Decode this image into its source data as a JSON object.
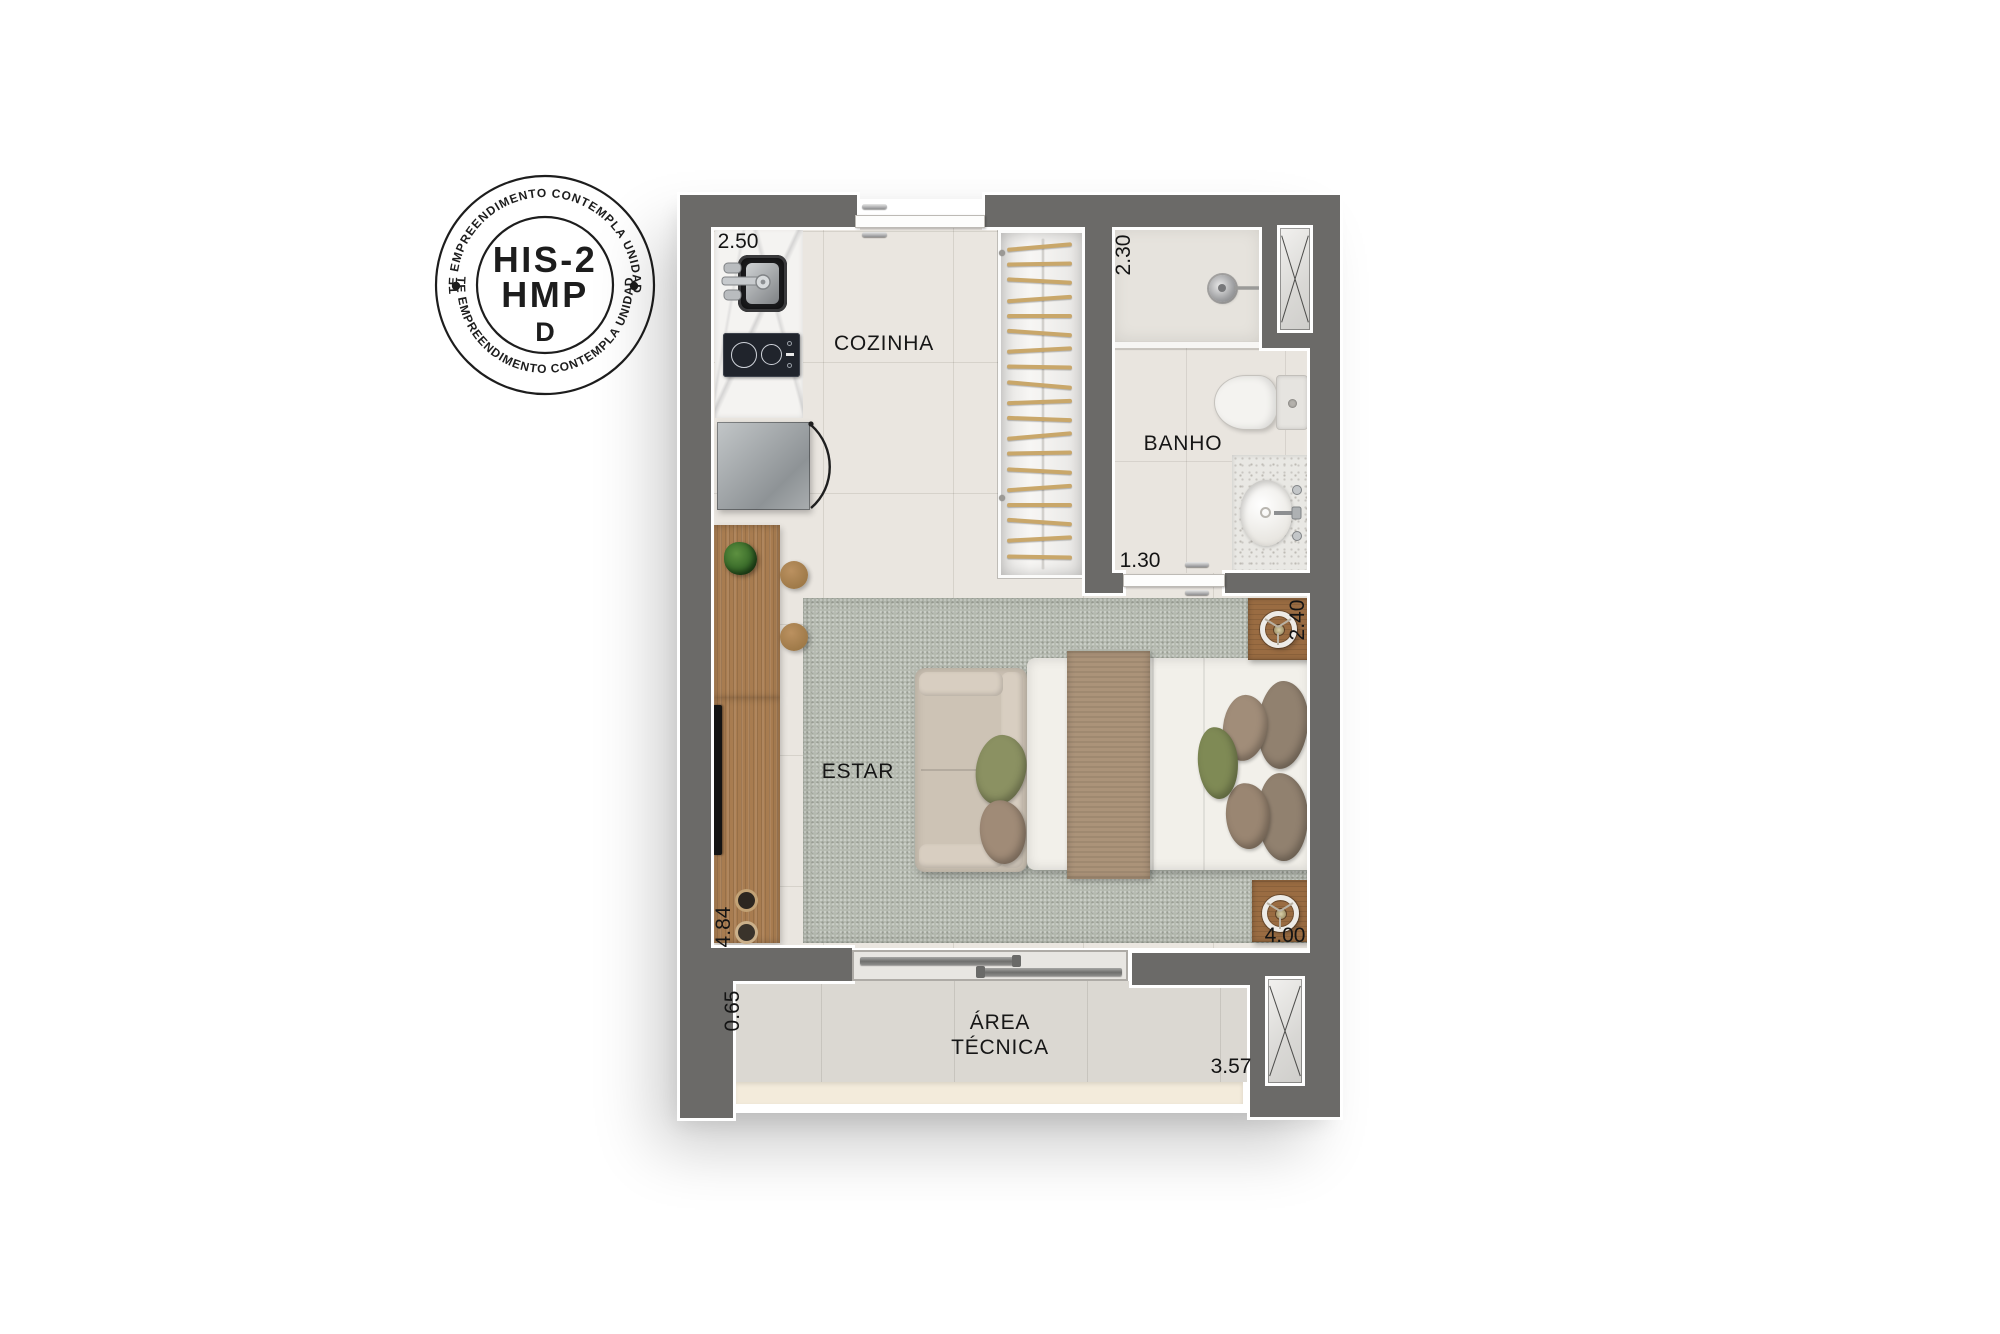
{
  "stamp": {
    "arc_text_top": "ESTE EMPREENDIMENTO CONTEMPLA UNIDADES",
    "arc_text_bottom": "ESTE EMPREENDIMENTO CONTEMPLA UNIDADES",
    "code_line1": "HIS-2",
    "code_line2": "HMP",
    "logo_letter": "D"
  },
  "rooms": {
    "kitchen": "COZINHA",
    "bathroom": "BANHO",
    "living": "ESTAR",
    "technical_line1": "ÁREA",
    "technical_line2": "TÉCNICA"
  },
  "dimensions": {
    "kitchen_top": "2.50",
    "shower_side": "2.30",
    "bathroom_door": "1.30",
    "bed_side": "2.40",
    "living_left": "4.84",
    "living_bottom": "4.00",
    "technical_left": "0.65",
    "technical_bottom": "3.57"
  },
  "colors": {
    "wall": "#6b6a68",
    "tile_floor": "#eae6e0",
    "rug": "#b5bab0",
    "wood": "#a87c50",
    "balcony_floor": "#dbd8d2",
    "screed": "#f3ebdb",
    "accent_green": "#8b9162",
    "linen": "#f2f0ea",
    "blanket": "#ab9379",
    "ink": "#1d1d1d"
  }
}
